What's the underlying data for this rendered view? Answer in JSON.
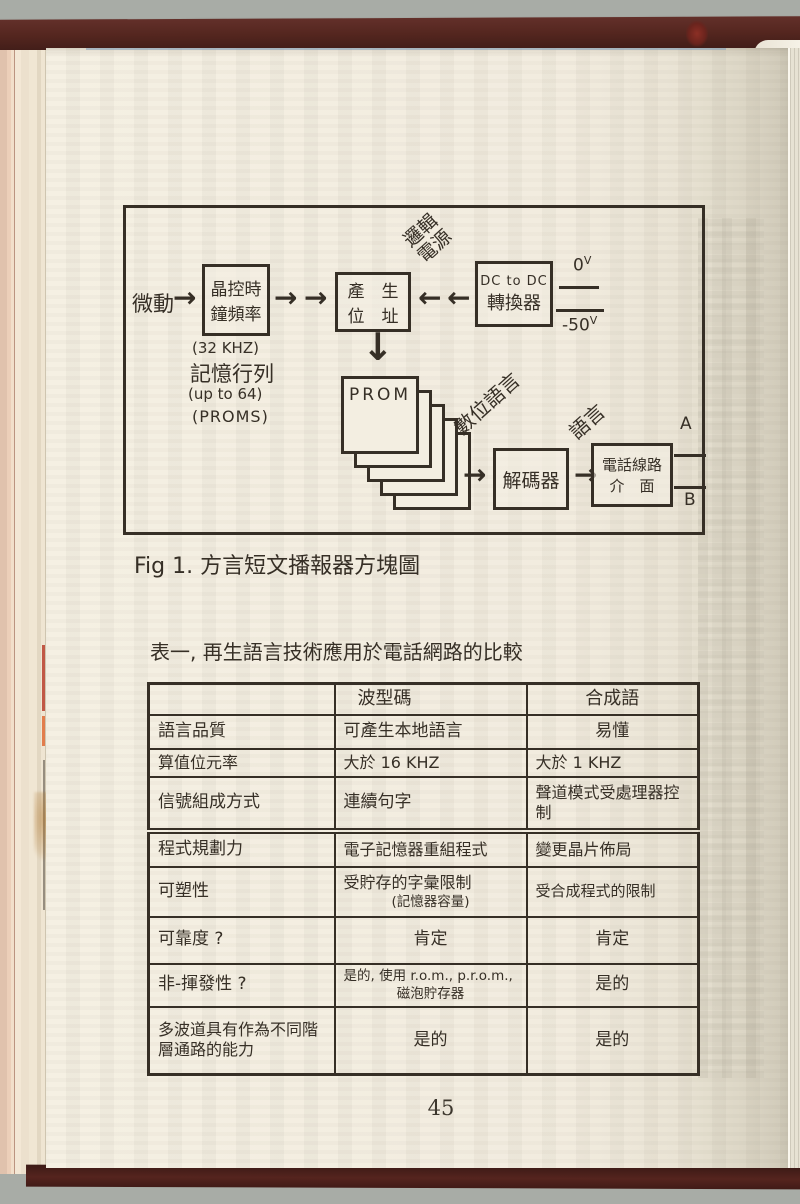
{
  "photo": {
    "background_color": "#a8aca6",
    "cover_color": "#4e221d",
    "page_color": "#f2ecdf",
    "ink_color": "#362f26"
  },
  "icons": {
    "arrow_right": "→",
    "arrow_left": "←",
    "arrow_down": "↓"
  },
  "diagram": {
    "trigger_label": "微動",
    "clock_box": {
      "line1": "晶控時",
      "line2": "鐘頻率"
    },
    "clock_notes": [
      "(32 KHZ)",
      "記憶行列",
      "(up to 64)",
      "(PROMS)"
    ],
    "address_box": {
      "line1": "產　生",
      "line2": "位　址"
    },
    "logic_power_label": {
      "line1": "邏輯",
      "line2": "電源"
    },
    "dcdc_box": {
      "line1": "DC to DC",
      "line2": "轉換器"
    },
    "rails": [
      {
        "value": "0",
        "unit": "V"
      },
      {
        "value": "-50",
        "unit": "V"
      }
    ],
    "prom_label": "PROM",
    "digital_speech_label": "數位語言",
    "decoder_box": "解碼器",
    "speech_label": "語言",
    "phone_box": {
      "line1": "電話線路",
      "line2": "介　面"
    },
    "line_a": "A",
    "line_b": "B"
  },
  "figure_caption": "Fig 1. 方言短文播報器方塊圖",
  "table": {
    "title": "表一, 再生語言技術應用於電話網路的比較",
    "columns": [
      "",
      "波型碼",
      "合成語"
    ],
    "rows": [
      {
        "label": "語言品質",
        "waveform": "可產生本地語言",
        "synth": "易懂"
      },
      {
        "label": "算值位元率",
        "waveform": "大於 16 KHZ",
        "synth": "大於 1 KHZ"
      },
      {
        "label": "信號組成方式",
        "waveform": "連續句字",
        "synth": "聲道模式受處理器控制"
      },
      {
        "label": "程式規劃力",
        "waveform": "電子記憶器重組程式",
        "synth": "變更晶片佈局"
      },
      {
        "label": "可塑性",
        "waveform": "受貯存的字彙限制",
        "waveform_note": "(記憶器容量)",
        "synth": "受合成程式的限制"
      },
      {
        "label": "可靠度 ?",
        "waveform": "肯定",
        "synth": "肯定"
      },
      {
        "label": "非-揮發性 ?",
        "waveform": "是的, 使用 r.o.m., p.r.o.m.,",
        "waveform_note": "磁泡貯存器",
        "synth": "是的"
      },
      {
        "label": "多波道具有作為不同階層通路的能力",
        "waveform": "是的",
        "synth": "是的"
      }
    ]
  },
  "page_number": "45"
}
